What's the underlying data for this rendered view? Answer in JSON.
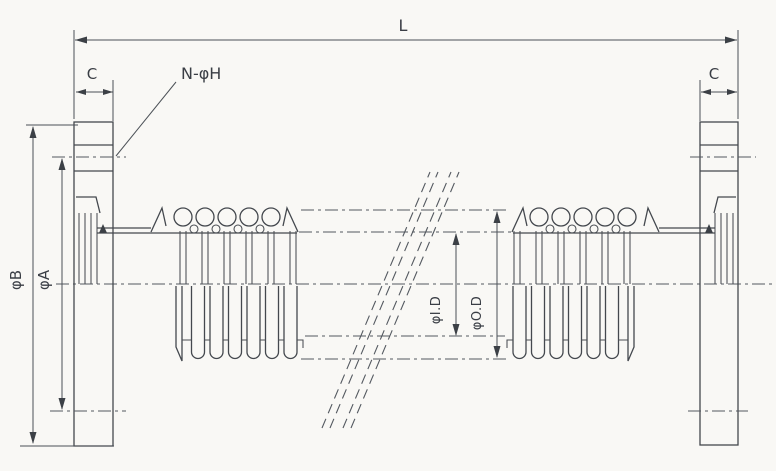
{
  "drawing": {
    "labels": {
      "overall_length": "L",
      "flange_thickness_left": "C",
      "flange_thickness_right": "C",
      "bolt_holes": "N-φH",
      "flange_outer_diameter": "φB",
      "bolt_circle_diameter": "φA",
      "bellows_inner_diameter": "φI.D",
      "bellows_outer_diameter": "φO.D"
    },
    "colors": {
      "background": "#f9f8f5",
      "line": "#44484e",
      "dimension_line": "#4c5157",
      "text": "#3a3e45"
    }
  }
}
